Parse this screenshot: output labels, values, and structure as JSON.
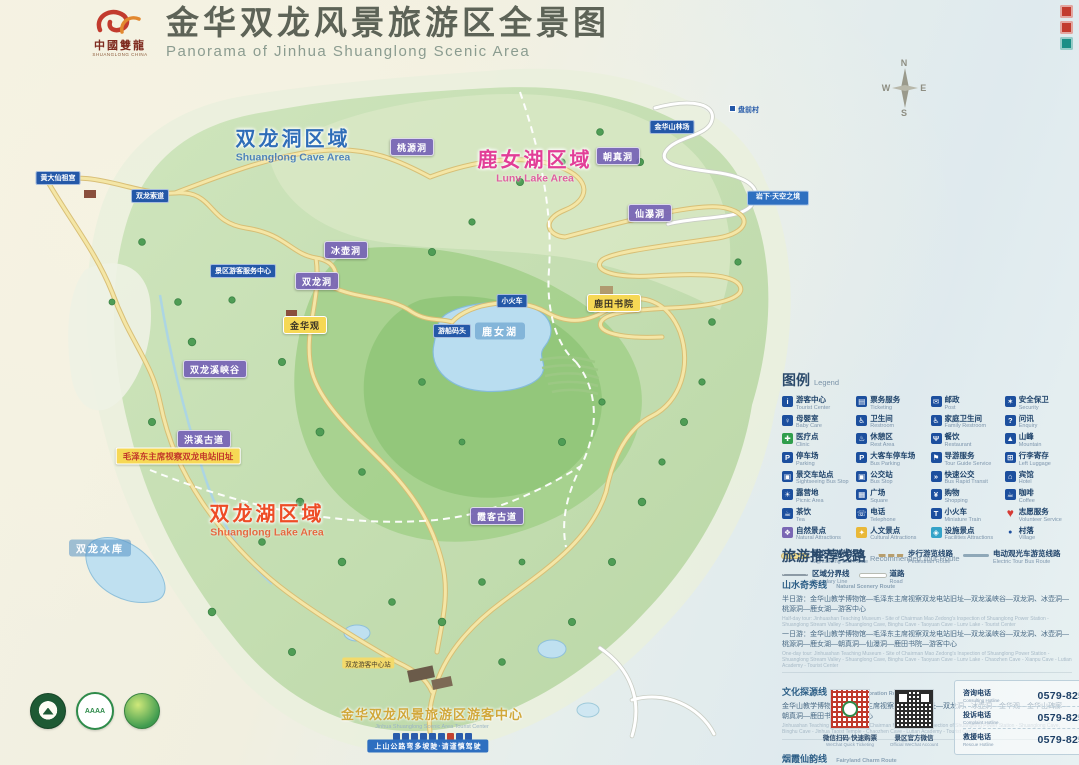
{
  "header": {
    "logo_zh": "中國雙龍",
    "logo_en": "SHUANGLONG CHINA",
    "title_zh": "金华双龙风景旅游区全景图",
    "title_en": "Panorama of Jinhua Shuanglong Scenic Area"
  },
  "compass": {
    "n": "N",
    "w": "W",
    "e": "E",
    "s": "S"
  },
  "regions": [
    {
      "zh": "双龙洞区域",
      "en": "Shuanglong Cave Area",
      "color": "#2f6db8",
      "x": 293,
      "y": 143
    },
    {
      "zh": "鹿女湖区域",
      "en": "Lunv Lake Area",
      "color": "#e23e97",
      "x": 535,
      "y": 164
    },
    {
      "zh": "双龙湖区域",
      "en": "Shuanglong Lake Area",
      "color": "#ee4c26",
      "x": 267,
      "y": 518
    }
  ],
  "map_labels": [
    {
      "t": "桃源洞",
      "x": 412,
      "y": 147,
      "s": "purple"
    },
    {
      "t": "朝真洞",
      "x": 618,
      "y": 156,
      "s": "purple"
    },
    {
      "t": "冰壶洞",
      "x": 346,
      "y": 250,
      "s": "purple"
    },
    {
      "t": "双龙洞",
      "x": 317,
      "y": 281,
      "s": "purple"
    },
    {
      "t": "仙瀑洞",
      "x": 650,
      "y": 213,
      "s": "purple"
    },
    {
      "t": "双龙溪峡谷",
      "x": 215,
      "y": 369,
      "s": "purple"
    },
    {
      "t": "洪溪古道",
      "x": 204,
      "y": 439,
      "s": "purple"
    },
    {
      "t": "霞客古道",
      "x": 497,
      "y": 516,
      "s": "purple"
    },
    {
      "t": "金华观",
      "x": 305,
      "y": 325,
      "s": "yellow"
    },
    {
      "t": "鹿田书院",
      "x": 614,
      "y": 303,
      "s": "yellow"
    },
    {
      "t": "毛泽东主席视察双龙电站旧址",
      "x": 178,
      "y": 456,
      "s": "mao"
    },
    {
      "t": "鹿女湖",
      "x": 500,
      "y": 331,
      "s": "water"
    },
    {
      "t": "双龙水库",
      "x": 100,
      "y": 548,
      "s": "water"
    },
    {
      "t": "景区游客服务中心",
      "x": 243,
      "y": 271,
      "s": "blue"
    },
    {
      "t": "双龙索道",
      "x": 150,
      "y": 196,
      "s": "blue"
    },
    {
      "t": "黄大仙祖宫",
      "x": 58,
      "y": 178,
      "s": "blue"
    },
    {
      "t": "小火车",
      "x": 512,
      "y": 301,
      "s": "blue"
    },
    {
      "t": "游船码头",
      "x": 452,
      "y": 331,
      "s": "blue"
    },
    {
      "t": "金华山林场",
      "x": 672,
      "y": 127,
      "s": "blue"
    },
    {
      "t": "岩下·天空之境",
      "x": 778,
      "y": 198,
      "s": "blue2"
    },
    {
      "t": "盘前村",
      "x": 744,
      "y": 110,
      "s": "village"
    },
    {
      "t": "双龙游客中心站",
      "x": 368,
      "y": 663,
      "s": "smallyellow"
    },
    {
      "t": "上山公路弯多坡陡·请谨慎驾驶",
      "x": 428,
      "y": 746,
      "s": "banner"
    }
  ],
  "legend": {
    "title_zh": "图例",
    "title_en": "Legend",
    "items": [
      {
        "zh": "游客中心",
        "en": "Tourist Center",
        "icon": "info"
      },
      {
        "zh": "票务服务",
        "en": "Ticketing",
        "icon": "ticket"
      },
      {
        "zh": "邮政",
        "en": "Post",
        "icon": "post"
      },
      {
        "zh": "安全保卫",
        "en": "Security",
        "icon": "security"
      },
      {
        "zh": "母婴室",
        "en": "Baby Care",
        "icon": "baby"
      },
      {
        "zh": "卫生间",
        "en": "Restroom",
        "icon": "toilet"
      },
      {
        "zh": "家庭卫生间",
        "en": "Family Restroom",
        "icon": "family-toilet"
      },
      {
        "zh": "问讯",
        "en": "Enquiry",
        "icon": "enquiry"
      },
      {
        "zh": "医疗点",
        "en": "Clinic",
        "icon": "clinic",
        "icon_c": "#2f9e4c"
      },
      {
        "zh": "休憩区",
        "en": "Rest Area",
        "icon": "rest"
      },
      {
        "zh": "餐饮",
        "en": "Restaurant",
        "icon": "restaurant"
      },
      {
        "zh": "山峰",
        "en": "Mountain",
        "icon": "mountain"
      },
      {
        "zh": "停车场",
        "en": "Parking",
        "icon": "parking"
      },
      {
        "zh": "大客车停车场",
        "en": "Bus Parking",
        "icon": "bus-parking"
      },
      {
        "zh": "导游服务",
        "en": "Tour Guide Service",
        "icon": "guide"
      },
      {
        "zh": "行李寄存",
        "en": "Left Luggage",
        "icon": "luggage"
      },
      {
        "zh": "景交车站点",
        "en": "Sightseeing Bus Stop",
        "icon": "sight-bus"
      },
      {
        "zh": "公交站",
        "en": "Bus Stop",
        "icon": "bus"
      },
      {
        "zh": "快速公交",
        "en": "Bus Rapid Transit",
        "icon": "brt"
      },
      {
        "zh": "宾馆",
        "en": "Hotel",
        "icon": "hotel"
      },
      {
        "zh": "露营地",
        "en": "Picnic Area",
        "icon": "picnic"
      },
      {
        "zh": "广场",
        "en": "Square",
        "icon": "square"
      },
      {
        "zh": "购物",
        "en": "Shopping",
        "icon": "shopping"
      },
      {
        "zh": "咖啡",
        "en": "Coffee",
        "icon": "coffee"
      },
      {
        "zh": "茶饮",
        "en": "Tea",
        "icon": "tea"
      },
      {
        "zh": "电话",
        "en": "Telephone",
        "icon": "phone"
      },
      {
        "zh": "小火车",
        "en": "Miniature Train",
        "icon": "train"
      },
      {
        "zh": "志愿服务",
        "en": "Volunteer Service",
        "icon": "volunteer",
        "s": "heart"
      },
      {
        "zh": "自然景点",
        "en": "Natural Attractions",
        "icon": "natural",
        "icon_c": "#7a67b4"
      },
      {
        "zh": "人文景点",
        "en": "Cultural Attractions",
        "icon": "cultural",
        "icon_c": "#e9b838"
      },
      {
        "zh": "设施景点",
        "en": "Facilities Attractions",
        "icon": "facility",
        "icon_c": "#35a3c8"
      },
      {
        "zh": "村落",
        "en": "Village",
        "icon": "village",
        "s": "vdot"
      }
    ],
    "lines": [
      {
        "zh": "景交车游览线路",
        "en": "Sightseeing Bus Route",
        "s": "line-bus"
      },
      {
        "zh": "步行游览线路",
        "en": "Pedestrian Route",
        "s": "line-walk"
      },
      {
        "zh": "电动观光车游览线路",
        "en": "Electric Tour Bus Route",
        "s": "line-ev"
      },
      {
        "zh": "区域分界线",
        "en": "Boundary Line",
        "s": "line-bound"
      },
      {
        "zh": "道路",
        "en": "Road",
        "s": "line-road"
      }
    ]
  },
  "routes": {
    "title_zh": "旅游推荐线路",
    "title_en": "Recommended Tour Route",
    "sections": [
      {
        "name_zh": "山水奇秀线",
        "name_en": "Natural Scenery Route",
        "paras": [
          {
            "zh": "半日游：金华山教学博物馆—毛泽东主席视察双龙电站旧址—双龙溪峡谷—双龙洞、冰壶洞—桃源洞—鹿女湖—游客中心",
            "en": "Half-day tour: Jinhuashan Teaching Museum - Site of Chairman Mao Zedong's Inspection of Shuanglong Power Station - Shuanglong Stream Valley - Shuanglong Cave, Binghu Cave - Taoyuan Cave - Lunv Lake - Tourist Center"
          },
          {
            "zh": "一日游：金华山教学博物馆—毛泽东主席视察双龙电站旧址—双龙溪峡谷—双龙洞、冰壶洞—桃源洞—鹿女湖—朝真洞—仙瀑洞—鹿田书院—游客中心",
            "en": "One-day tour: Jinhuashan Teaching Museum - Site of Chairman Mao Zedong's Inspection of Shuanglong Power Station - Shuanglong Stream Valley - Shuanglong Cave, Binghu Cave - Taoyuan Cave - Lunv Lake - Chaozhen Cave - Xianpu Cave - Lutian Academy - Tourist Center"
          }
        ]
      },
      {
        "name_zh": "文化探源线",
        "name_en": "Culture Exploration Route",
        "paras": [
          {
            "zh": "金华山教学博物馆—毛泽东主席视察双龙电站旧址—双龙洞、冰壶洞—金华观—金华山碑廊—朝真洞—鹿田书院—游客中心",
            "en": "Jinhuashan Teaching Museum - Site of Chairman Mao Zedong's Inspection of Shuanglong Power Station - Shuanglong Cave, Binghu Cave - Jinhua Taoist Temple - Chaozhen Cave - Lutian Academy - Tourist Center"
          }
        ]
      },
      {
        "name_zh": "烟霞仙韵线",
        "name_en": "Fairyland Charm Route",
        "paras": [
          {
            "zh": "金华山教学博物馆—双龙洞、冰壶洞—朝真洞—仙瀑洞—鹿田书院—霞客古道—游客中心",
            "en": "Jinhuashan Teaching Museum - Shuanglong Cave, Binghu Cave - Chaozhen Cave - Xianpu Cave - Lutian Academy - Xiake Ancient Trail - Tourist Center"
          }
        ]
      }
    ]
  },
  "contact": {
    "qrs": [
      {
        "zh": "微信扫码·快速购票",
        "en": "WeChat Quick Ticketing",
        "s": "pay"
      },
      {
        "zh": "景区官方微信",
        "en": "Official WeChat Account",
        "s": "wechat"
      }
    ],
    "phones": [
      {
        "zh": "咨询电话",
        "en": "Consulting Hotline",
        "num": "0579-82598016"
      },
      {
        "zh": "投诉电话",
        "en": "Complaint Hotline",
        "num": "0579-82598017"
      },
      {
        "zh": "救援电话",
        "en": "Rescue Hotline",
        "num": "0579-82598697"
      }
    ]
  },
  "footer_badges": [
    {
      "s": "seal",
      "label": "国家级风景名胜区"
    },
    {
      "s": "aaaa",
      "label": "国家AAAA级旅游景区",
      "text": "AAAA"
    },
    {
      "s": "forest",
      "label": "国家森林公园"
    }
  ],
  "visitor_center": {
    "zh": "金华双龙风景旅游区游客中心",
    "en": "Jinhua Shuanglong Scenic Area Tourist Center",
    "icon_rows": [
      9,
      8
    ]
  }
}
